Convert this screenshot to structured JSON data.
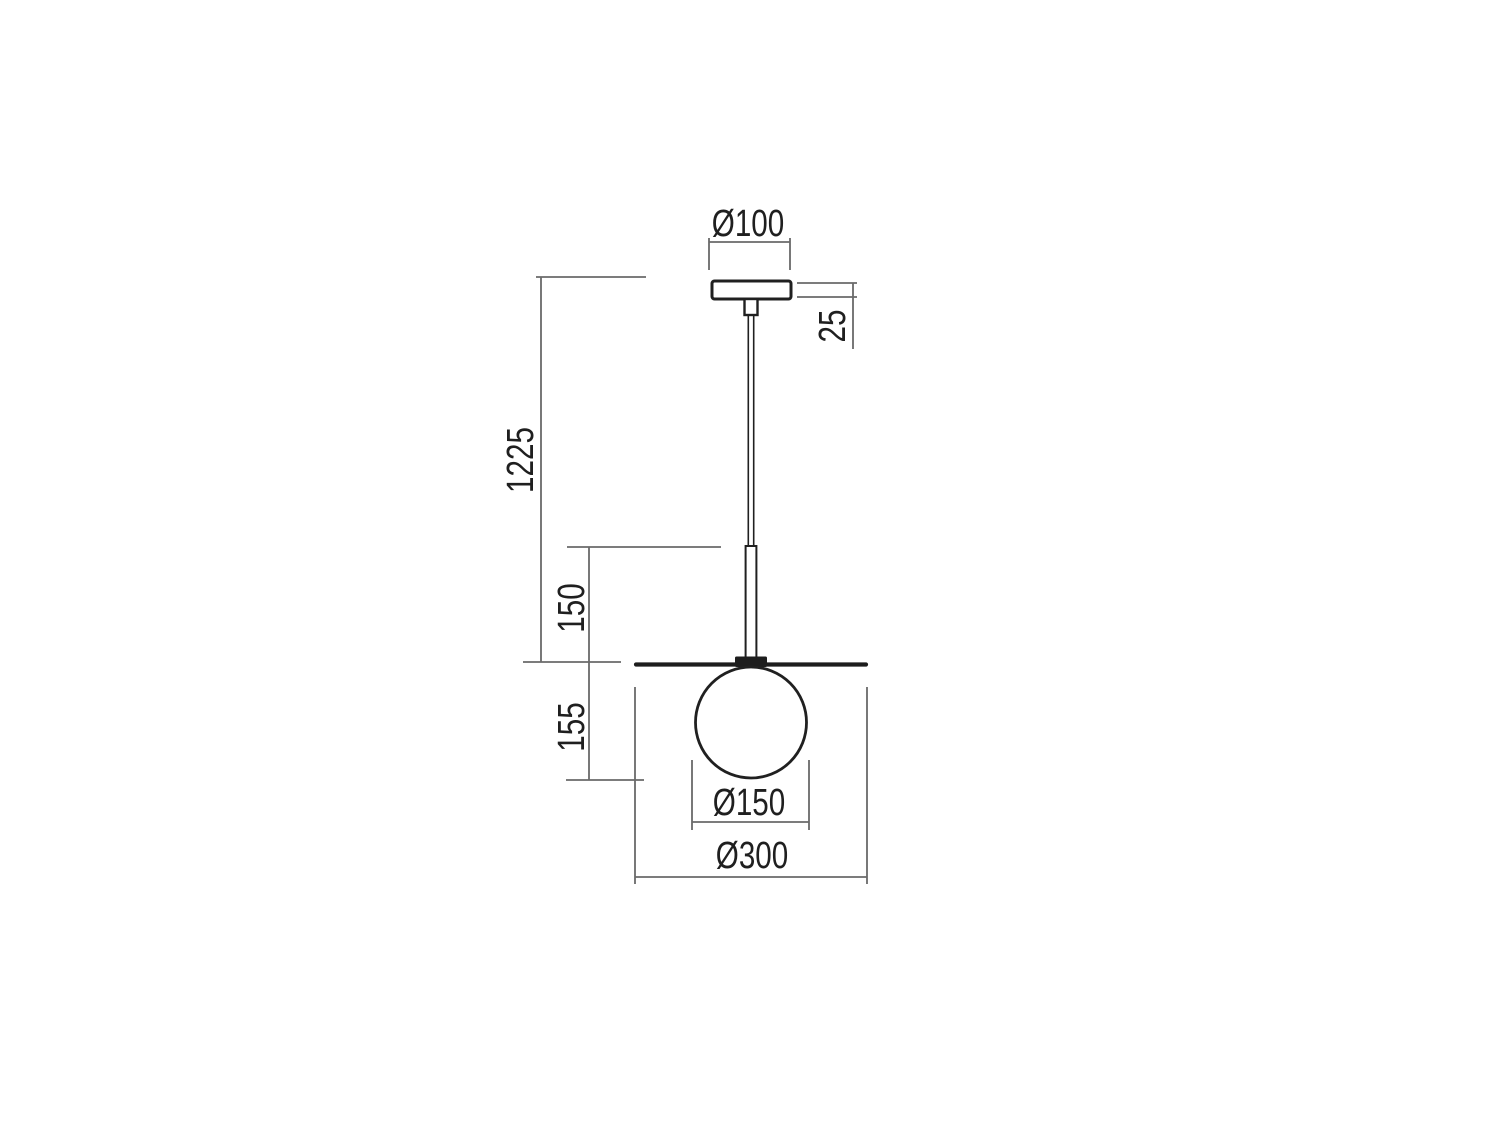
{
  "drawing": {
    "labels": {
      "canopy_diameter": "Ø100",
      "canopy_height": "25",
      "total_drop": "1225",
      "rod_length": "150",
      "globe_drop": "155",
      "globe_diameter": "Ø150",
      "disc_diameter": "Ø300"
    },
    "colors": {
      "background": "#ffffff",
      "outline": "#202020",
      "dimension_lines": "#6a6a6a",
      "text": "#1f1f1f",
      "solid_parts": "#1d1d1d"
    }
  }
}
